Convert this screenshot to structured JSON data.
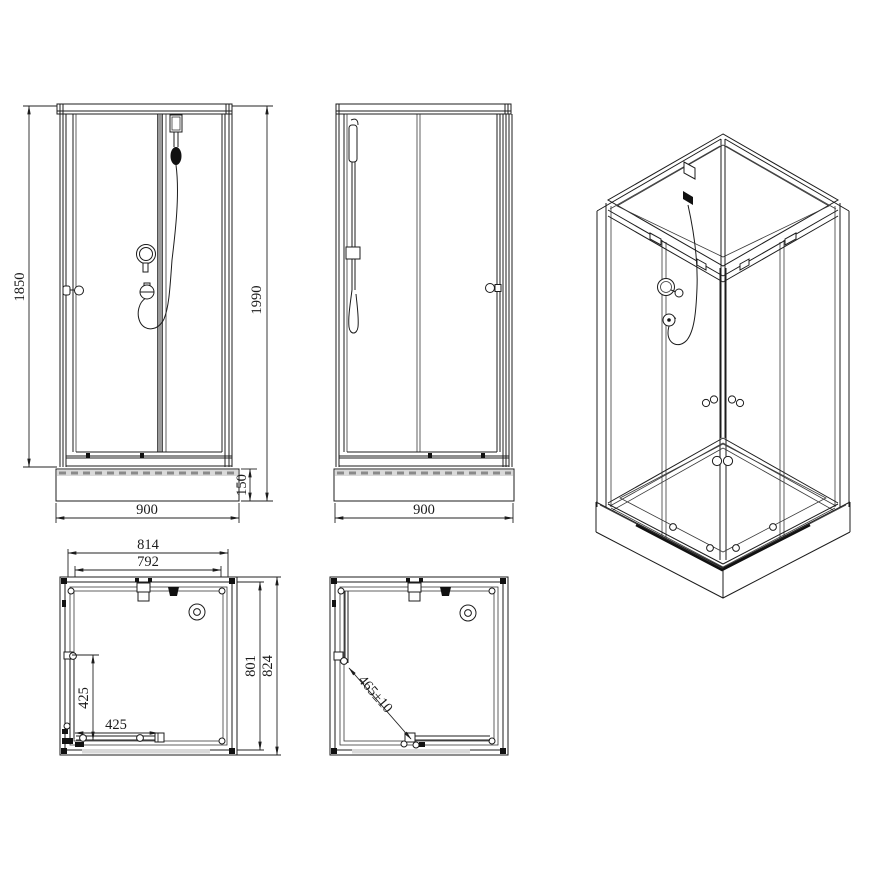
{
  "front": {
    "glass_height": "1850",
    "total_height": "1990",
    "tray_height": "150",
    "width": "900"
  },
  "side": {
    "width": "900"
  },
  "plan_closed": {
    "outer_width": "814",
    "inner_width": "792",
    "inner_depth": "801",
    "outer_depth": "824",
    "door_half_left": "425",
    "door_half_bottom": "425"
  },
  "plan_open": {
    "diagonal_opening": "465±10"
  },
  "colors": {
    "line": "#1c1c1c",
    "divider_gray": "#9a9a9a",
    "tray_band_gray": "#d9d9d9",
    "fitting_black": "#111111"
  }
}
